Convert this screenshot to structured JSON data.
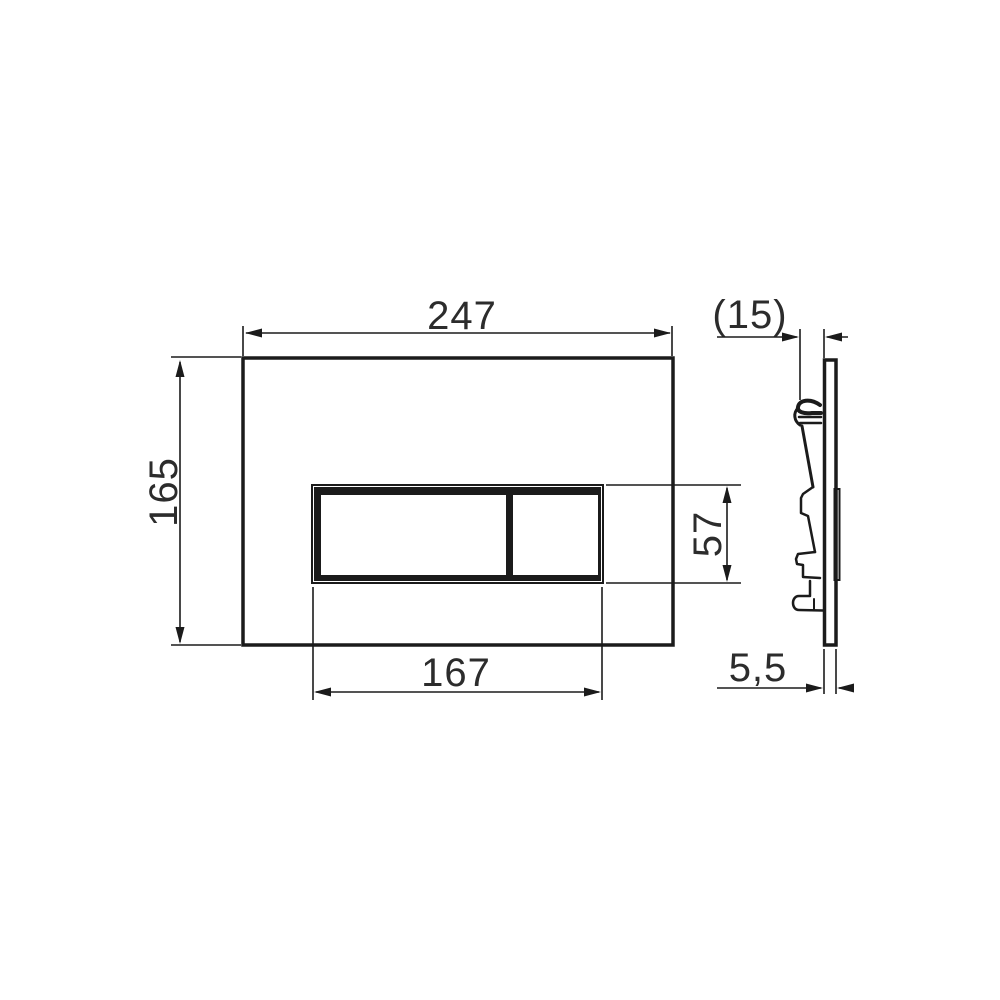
{
  "drawing": {
    "type": "technical-dimension-drawing",
    "dims": {
      "plate_width": "247",
      "plate_height": "165",
      "buttons_width": "167",
      "buttons_height": "57",
      "depth_overall": "(15)",
      "plate_thickness": "5,5"
    },
    "colors": {
      "line": "#1b1b1b",
      "text": "#2c2c2c",
      "background": "#ffffff"
    }
  }
}
